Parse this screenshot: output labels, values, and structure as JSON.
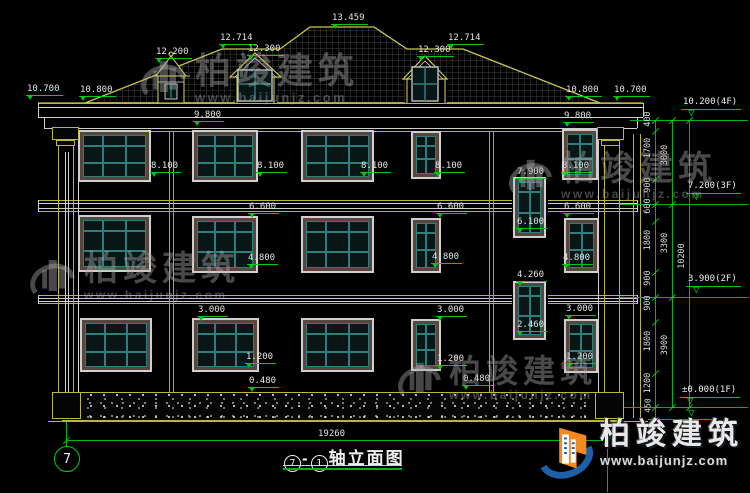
{
  "levels": {
    "v13459": "13.459",
    "v12714": "12.714",
    "v12200": "12.200",
    "v12300": "12.300",
    "v10800": "10.800",
    "v10700": "10.700",
    "v9800": "9.800",
    "v8100": "8.100",
    "v7900": "7.900",
    "v6600": "6.600",
    "v6100": "6.100",
    "v4800": "4.800",
    "v4260": "4.260",
    "v3000": "3.000",
    "v2460": "2.460",
    "v1200": "1.200",
    "v0480": "0.480"
  },
  "floor_levels": {
    "f4": "10.200(4F)",
    "f3": "7.200(3F)",
    "f2": "3.900(2F)",
    "f1": "±0.000(1F)"
  },
  "chain": {
    "col1": [
      "400",
      "1700",
      "900",
      "600",
      "1800",
      "900",
      "900",
      "1800",
      "1200"
    ],
    "col2": [
      "3000",
      "3300",
      "3900"
    ],
    "col3": [
      "10200"
    ],
    "below_zero": "450"
  },
  "dims": {
    "overall_width": "19260"
  },
  "axes": {
    "left_bubble": "7"
  },
  "title": {
    "axis_start": "7",
    "separator": "-",
    "axis_end": "1",
    "name": "轴立面图"
  },
  "brand": {
    "name": "柏竣建筑",
    "site": "www.baijunjz.com"
  }
}
